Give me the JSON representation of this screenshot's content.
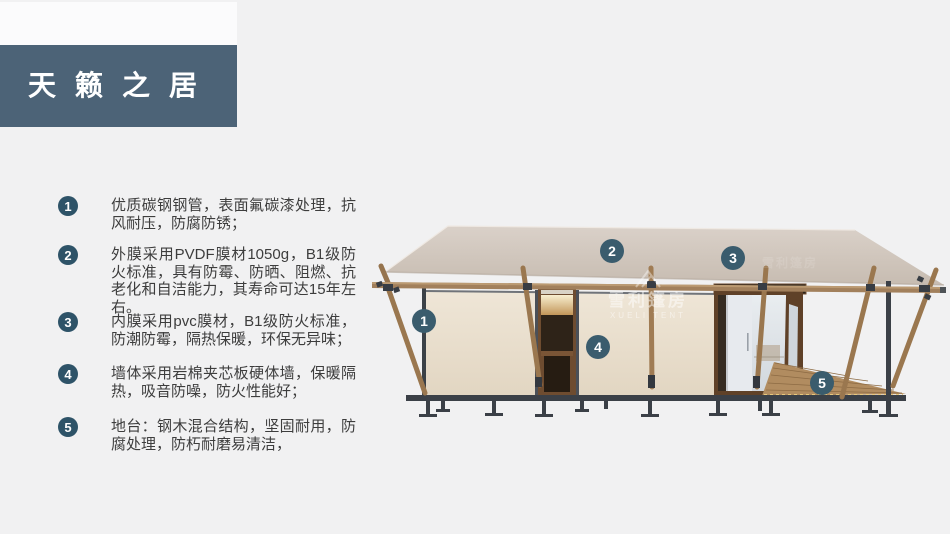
{
  "page": {
    "title": "天籁之居"
  },
  "features": {
    "items": [
      {
        "num": "1",
        "text": "优质碳钢钢管，表面氟碳漆处理，抗风耐压，防腐防锈；"
      },
      {
        "num": "2",
        "text": "外膜采用PVDF膜材1050g，B1级防火标准，具有防霉、防晒、阻燃、抗老化和自洁能力，其寿命可达15年左右。"
      },
      {
        "num": "3",
        "text": "内膜采用pvc膜材，B1级防火标准，防潮防霉，隔热保暖，环保无异味；"
      },
      {
        "num": "4",
        "text": "墙体采用岩棉夹芯板硬体墙，保暖隔热，吸音防噪，防火性能好；"
      },
      {
        "num": "5",
        "text": "地台：钢木混合结构，坚固耐用，防腐处理，防朽耐磨易清洁，"
      }
    ]
  },
  "diagram": {
    "callouts": [
      {
        "num": "1"
      },
      {
        "num": "2"
      },
      {
        "num": "3"
      },
      {
        "num": "4"
      },
      {
        "num": "5"
      }
    ],
    "watermark": {
      "cn": "雪利篷房",
      "en": "XUELI TENT"
    }
  },
  "colors": {
    "accent": "#4c6377",
    "bullet": "#2e5368",
    "badge": "#3a5c6d"
  }
}
